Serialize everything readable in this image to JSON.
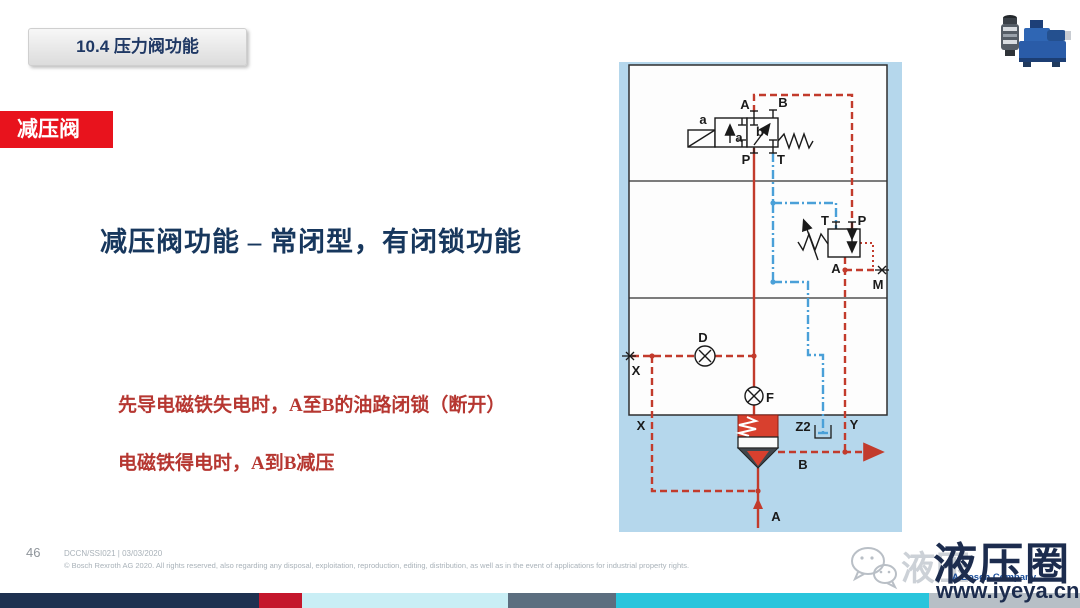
{
  "slide": {
    "section_badge": "10.4 压力阀功能",
    "topic_badge": "减压阀",
    "title": "减压阀功能 – 常闭型，有闭锁功能",
    "bullet1": "先导电磁铁失电时，A至B的油路闭锁（断开）",
    "bullet2": "电磁铁得电时，A到B减压"
  },
  "footer": {
    "page_number": "46",
    "doc_id": "DCCN/SSI021 | 03/03/2020",
    "copyright": "© Bosch Rexroth AG 2020. All rights reserved, also regarding any disposal, exploitation, reproduction, editing, distribution, as well as in the event of applications for industrial property rights."
  },
  "watermark": {
    "brand_gray": "液压",
    "brand": "液压圈",
    "bosch": "A Bosch Company",
    "url": "www.iyeya.cn"
  },
  "diagram": {
    "labels": {
      "a_solenoid": "a",
      "pos_a": "a",
      "pos_b": "b",
      "port_A": "A",
      "port_B": "B",
      "port_P": "P",
      "port_T": "T",
      "pilot_T": "T",
      "pilot_P": "P",
      "pilot_A": "A",
      "port_M": "M",
      "orifice_D": "D",
      "orifice_F": "F",
      "plug_X": "X",
      "port_X": "X",
      "port_Z2": "Z2",
      "port_Y": "Y",
      "port_B_out": "B",
      "port_A_in": "A"
    },
    "colors": {
      "panel_blue": "#b5d7ec",
      "line_red": "#c23b2c",
      "line_blue": "#4aa0d8",
      "valve_red": "#d8402e"
    }
  },
  "colors": {
    "accent_navy": "#17375d",
    "badge_red": "#e8131d",
    "text_red": "#b63731"
  },
  "stripe": {
    "segments": [
      {
        "color": "#1e3150",
        "width": 259
      },
      {
        "color": "#c4172c",
        "width": 43
      },
      {
        "color": "#c9eef5",
        "width": 206
      },
      {
        "color": "#5c6e7f",
        "width": 108
      },
      {
        "color": "#29c5dc",
        "width": 313
      },
      {
        "color": "#b7bfc6",
        "width": 151
      }
    ]
  }
}
